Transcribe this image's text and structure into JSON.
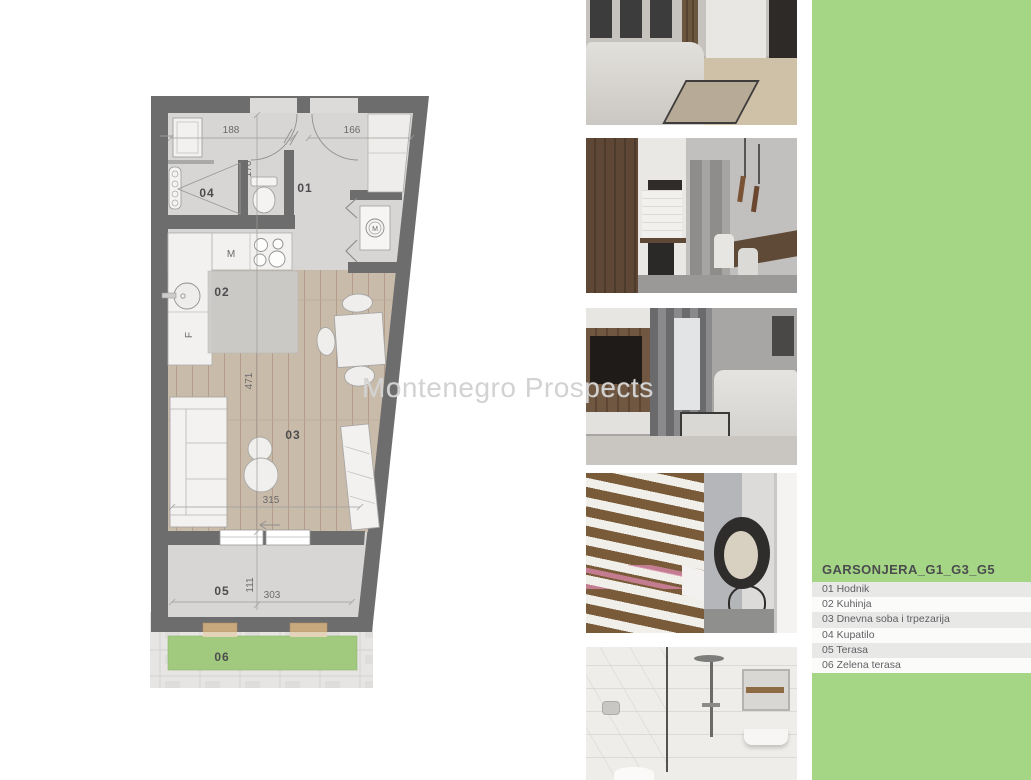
{
  "watermark": "Montenegro Prospects",
  "plan": {
    "rooms": {
      "r01": "01",
      "r02": "02",
      "r03": "03",
      "r04": "04",
      "r05": "05",
      "r06": "06"
    },
    "dims": {
      "d188": "188",
      "d166": "166",
      "d176": "176",
      "d471": "471",
      "d315": "315",
      "d111": "111",
      "d303": "303"
    },
    "fixtures": {
      "kitchen_unit": "M",
      "fridge": "F",
      "washer": "M"
    }
  },
  "photos": [
    {
      "label": "living room with corner sofa and kitchen"
    },
    {
      "label": "kitchen with dining table and pendant lights"
    },
    {
      "label": "living room with tv wall, curtains and sofa"
    },
    {
      "label": "balcony with wood slats and hanging chair"
    },
    {
      "label": "bathroom with glass shower"
    }
  ],
  "legend": {
    "title": "GARSONJERA_G1_G3_G5",
    "items": [
      "01 Hodnik",
      "02 Kuhinja",
      "03 Dnevna soba i trpezarija",
      "04 Kupatilo",
      "05 Terasa",
      "06 Zelena terasa"
    ]
  },
  "colors": {
    "panel_green": "#a5d685",
    "plan_green": "#a2ca7e",
    "wall_gray": "#6d6d6d",
    "wood_floor": "#c9bbaa"
  }
}
